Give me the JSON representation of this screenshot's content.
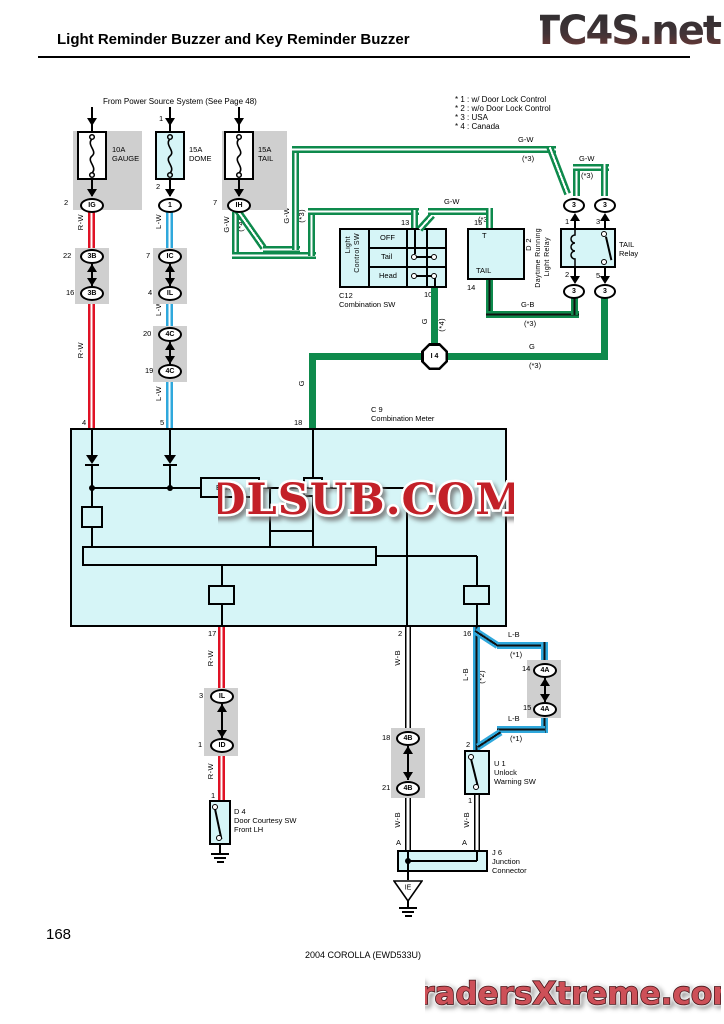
{
  "header": {
    "title": "Light Reminder Buzzer and Key Reminder Buzzer",
    "logo": "TC4S.net"
  },
  "notes": {
    "line1": "* 1 : w/ Door Lock Control",
    "line2": "* 2 : w/o Door Lock Control",
    "line3": "* 3 : USA",
    "line4": "* 4 : Canada"
  },
  "power_source_note": "From Power Source System (See Page 48)",
  "fuses": {
    "gauge": {
      "amp": "10A",
      "name": "GAUGE"
    },
    "dome": {
      "amp": "15A",
      "name": "DOME"
    },
    "tail": {
      "amp": "15A",
      "name": "TAIL"
    }
  },
  "wire_labels": {
    "rw": "R-W",
    "lw": "L-W",
    "gw": "G-W",
    "gb": "G-B",
    "g": "G",
    "wb": "W-B",
    "lb": "L-B",
    "s1": "(*1)",
    "s2": "(*2)",
    "s3": "(*3)",
    "s4": "(*4)"
  },
  "pins": {
    "p1": "1",
    "p2": "2",
    "p3": "3",
    "p4": "4",
    "p5": "5",
    "p7": "7",
    "p10": "10",
    "p13": "13",
    "p14": "14",
    "p15": "15",
    "p16": "16",
    "p17": "17",
    "p18": "18",
    "p19": "19",
    "p20": "20",
    "p21": "21",
    "p22": "22",
    "pa": "A"
  },
  "connectors": {
    "ig": "IG",
    "ih": "IH",
    "ic": "IC",
    "il": "IL",
    "id": "ID",
    "b3": "3B",
    "c4": "4C",
    "a4": "4A",
    "b4": "4B",
    "dome": "1",
    "relay": "3",
    "junction": "I 4",
    "ground": "IE"
  },
  "components": {
    "c12": {
      "id": "C12",
      "name": "Combination SW",
      "sw_line1": "Light",
      "sw_line2": "Control SW",
      "row_off": "OFF",
      "row_tail": "Tail",
      "row_head": "Head"
    },
    "d2": {
      "id": "D 2",
      "name_line1": "Daytime Running",
      "name_line2": "Light Relay",
      "t": "T",
      "tail": "TAIL"
    },
    "tail_relay": {
      "line1": "TAIL",
      "line2": "Relay"
    },
    "meter": {
      "id": "C 9",
      "name": "Combination Meter",
      "buzzer": "Buzzer"
    },
    "d4": {
      "id": "D 4",
      "line1": "Door Courtesy SW",
      "line2": "Front LH"
    },
    "u1": {
      "id": "U 1",
      "line1": "Unlock",
      "line2": "Warning SW"
    },
    "j6": {
      "id": "J 6",
      "line1": "Junction",
      "line2": "Connector"
    }
  },
  "watermarks": {
    "center": "DLSUB.COM",
    "bottom": "TradersXtreme.com"
  },
  "footer": {
    "page": "168",
    "model": "2004 COROLLA (EWD533U)"
  },
  "colors": {
    "green": "#0e8a4c",
    "red": "#e01225",
    "blue": "#2fa8dc",
    "cyan_fill": "#d6f5f7",
    "gray": "#cfcfcf",
    "watermark_red": "#c32028"
  }
}
